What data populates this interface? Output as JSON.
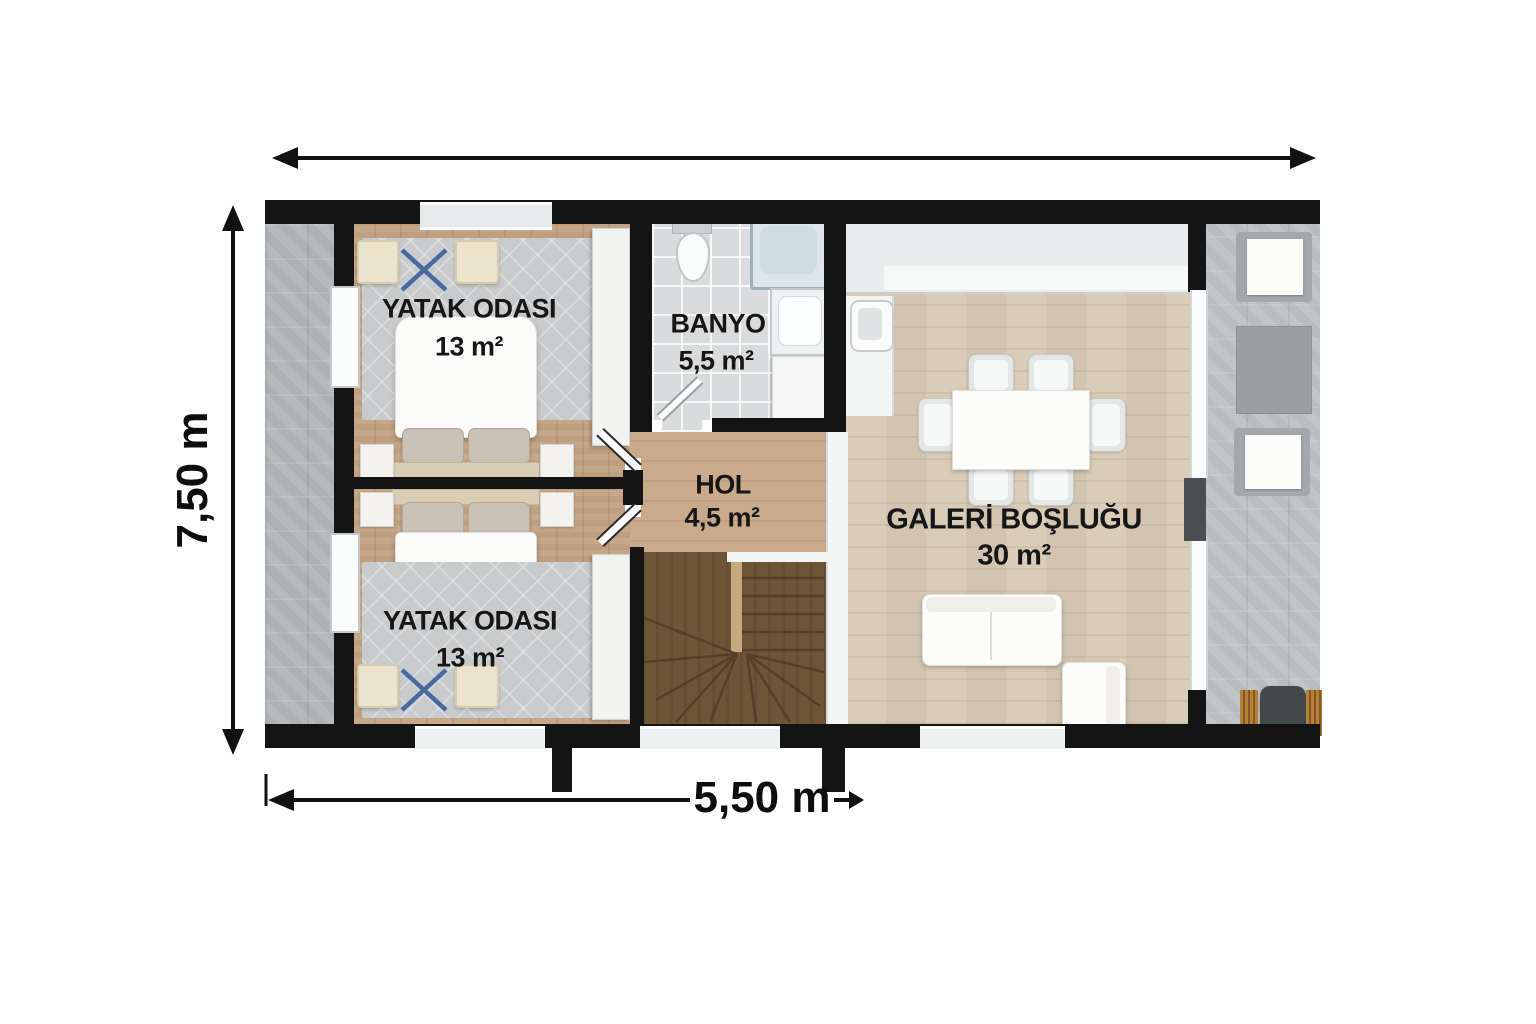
{
  "plan": {
    "rooms": [
      {
        "name": "YATAK ODASI",
        "area": "13 m²"
      },
      {
        "name": "BANYO",
        "area": "5,5 m²"
      },
      {
        "name": "HOL",
        "area": "4,5 m²"
      },
      {
        "name": "GALERİ BOŞLUĞU",
        "area": "30 m²"
      },
      {
        "name": "YATAK ODASI",
        "area": "13 m²"
      }
    ],
    "dimensions": {
      "height": "7,50 m",
      "width": "5,50 m"
    },
    "colors": {
      "wall": "#141414",
      "marker_x": "#3a5f9e",
      "stair_wood": "#6f5538"
    }
  }
}
